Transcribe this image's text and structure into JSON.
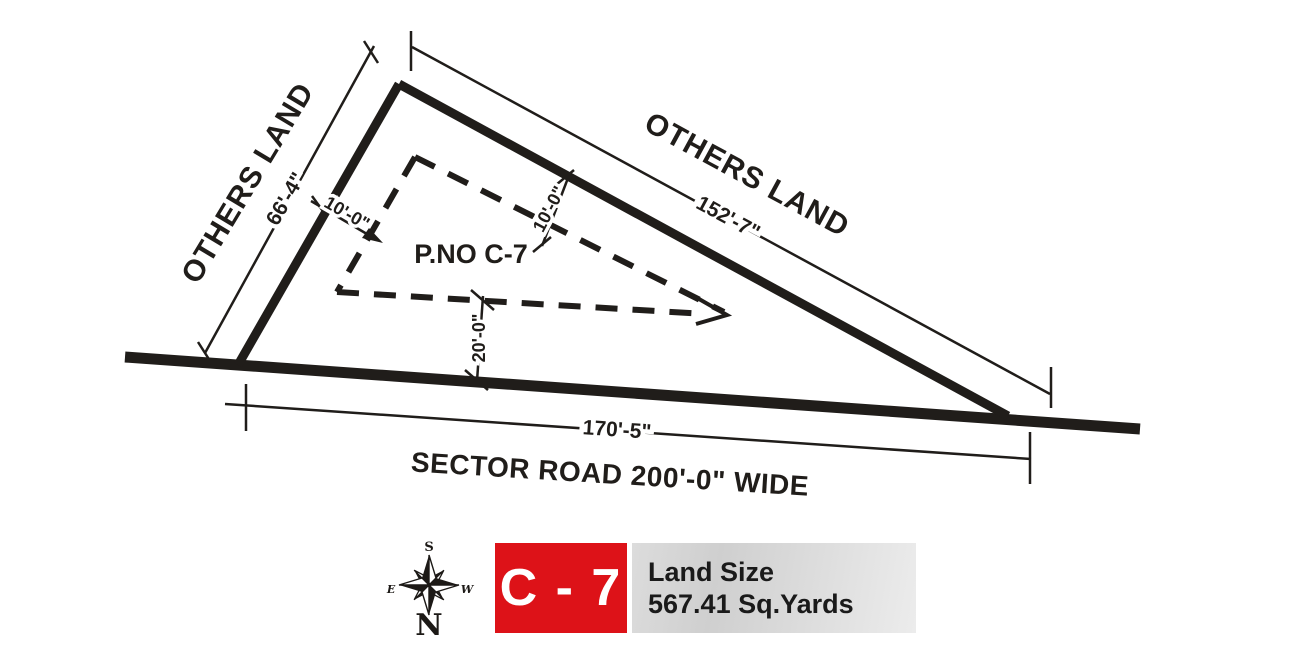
{
  "drawing": {
    "plot_label": "P.NO C-7",
    "left_side": {
      "owner_label": "OTHERS LAND",
      "dimension": "66'-4\""
    },
    "top_side": {
      "owner_label": "OTHERS LAND",
      "dimension": "152'-7\""
    },
    "bottom_side": {
      "road_label": "SECTOR ROAD 200'-0\" WIDE",
      "dimension": "170'-5\""
    },
    "setback_left": "10'-0\"",
    "setback_top": "10'-0\"",
    "setback_bottom": "20'-0\""
  },
  "compass": {
    "north": "N",
    "south": "S",
    "east": "E",
    "west": "W"
  },
  "legend": {
    "plot_number": "C - 7",
    "land_size_label": "Land Size",
    "land_size_value": "567.41 Sq.Yards"
  },
  "colors": {
    "ink": "#201d1a",
    "badge_red": "#dd1218",
    "panel_gray_dark": "#cfcfcf",
    "panel_gray_light": "#ececec"
  }
}
